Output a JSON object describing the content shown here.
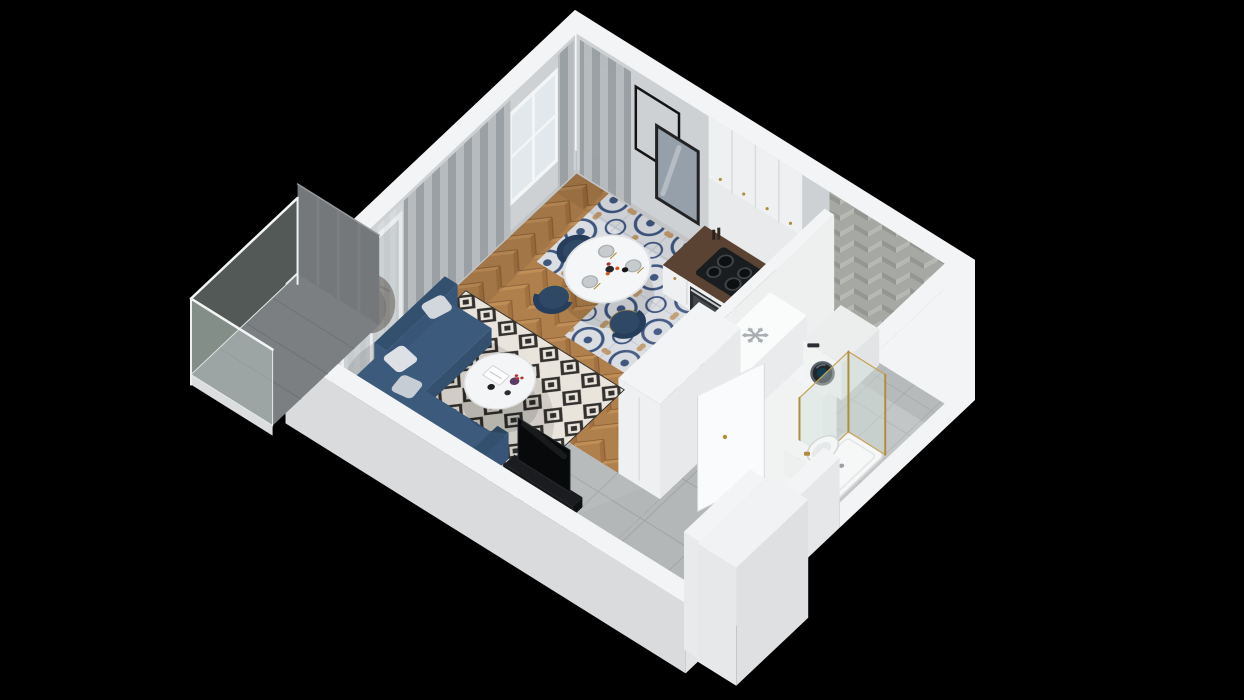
{
  "meta": {
    "description": "3D isometric floor plan render of a studio apartment viewed from above on a black background",
    "render_style": "isometric-cutaway",
    "background": "#000000"
  },
  "palette": {
    "background": "#000000",
    "wall_cap": "#f3f4f5",
    "wall_outer": "#e7e8ea",
    "wall_outer_sw": "#d9dbdd",
    "wall_inner": "#ced1d3",
    "wall_tile_base": "#a6a8a4",
    "wall_tile_light": "#b6b8b4",
    "wall_tile_dark": "#949692",
    "shower_niche": "#6e7173",
    "wood_base": "#b0804c",
    "wood_dark": "#a3713f",
    "wood_light": "#c08f57",
    "tile_base": "#dadee3",
    "tile_blue": "#3f567e",
    "tile_tan": "#c09a6e",
    "hall_tile": "#b4b7b8",
    "hall_grout": "#a0a3a4",
    "bath_tile": "#c3c6c7",
    "bath_grout": "#b0b3b4",
    "balcony_floor": "#7c7f82",
    "balcony_screen": "#75787b",
    "glass": "rgba(208,222,216,0.40)",
    "glass_frame": "#e3eae7",
    "rug_base": "#ebe8e1",
    "rug_ink": "#2f2f2d",
    "sofa": "#3c5a7c",
    "sofa_dark": "#33506e",
    "sofa_mid": "#385577",
    "pillow_light": "#dde1e6",
    "pillow_mid": "#c7cdd4",
    "chair_navy": "#2e4866",
    "chair_navy_dark": "#263e5c",
    "gold": "#b08d3e",
    "counter_wood": "#5a4332",
    "cabinet_white": "#eef0f1",
    "cabinet_seam": "#d9dbdc",
    "appliance_black": "#1a1d20",
    "oven_front": "#2b2e31",
    "tv_black": "#08090b",
    "curtain_a": "#989ea2",
    "curtain_b": "#b6babd",
    "sheer": "#d6d9db",
    "egg_chair": "#45403a",
    "washer_body": "#eceeee",
    "washer_door": "#21252a",
    "toilet_white": "#f5f7f7",
    "snowflake": "#a9aeb2",
    "plant_green": "#3f6b35",
    "plant_green2": "#4e7b40",
    "vase_purple": "#5b3b63",
    "flower_orange": "#d4541f",
    "flower_red": "#b03636"
  },
  "rooms": [
    {
      "name": "living-area",
      "floor": "herringbone-wood"
    },
    {
      "name": "dining-area",
      "floor": "ornamental-blue-tile"
    },
    {
      "name": "kitchen",
      "floor": "ornamental-blue-tile"
    },
    {
      "name": "hallway",
      "floor": "large-gray-tile"
    },
    {
      "name": "bathroom",
      "floor": "gray-tile",
      "walls": "herringbone-tile"
    },
    {
      "name": "balcony",
      "floor": "concrete",
      "railing": "glass"
    },
    {
      "name": "entry",
      "feature": "recessed-front-door"
    }
  ],
  "counts": {
    "dining_chairs": 3,
    "wardrobe_items": 14,
    "cooktop_burners": 4,
    "windows_nw_wall": 2,
    "upper_cabinet_doors": 4
  },
  "icons": [
    {
      "name": "snowflake-icon",
      "meaning": "refrigerator-position",
      "color": "#a9aeb2"
    }
  ],
  "inventory": [
    "corner-sofa-navy",
    "white-pillows",
    "round-coffee-table",
    "book",
    "purple-vase-with-flowers",
    "diamond-pattern-rug",
    "hanging-egg-chair",
    "gray-curtains",
    "sheer-curtains",
    "round-dining-table",
    "navy-dining-chairs-gold-legs",
    "table-setting-plates",
    "kitchen-upper-cabinets",
    "kitchen-counter-walnut-top",
    "induction-cooktop",
    "built-in-oven",
    "sink-gold-faucet",
    "refrigerator-cabinet",
    "tall-storage-cabinet",
    "picture-frame",
    "mirror",
    "tv-panel",
    "media-stand",
    "open-wardrobe-with-clothes",
    "potted-plant",
    "washing-machine",
    "wall-hung-toilet",
    "walk-in-shower-gold-frame",
    "bathroom-door-open",
    "entry-door-white",
    "balcony-glass-railing",
    "balcony-privacy-screen"
  ],
  "scene": {
    "elements": [
      "back-wall-nw",
      "back-wall-ne",
      "back-wall-se",
      "floors",
      "kitchen-counter",
      "partition-walls",
      "refrigerator",
      "tall-cabinet",
      "washing-machine",
      "shower",
      "toilet",
      "bathroom-door",
      "dining-set",
      "rug",
      "sofa",
      "coffee-table",
      "wardrobe",
      "tv-unit",
      "plant",
      "front-wall-sw",
      "entry",
      "vestibule",
      "balcony"
    ]
  }
}
